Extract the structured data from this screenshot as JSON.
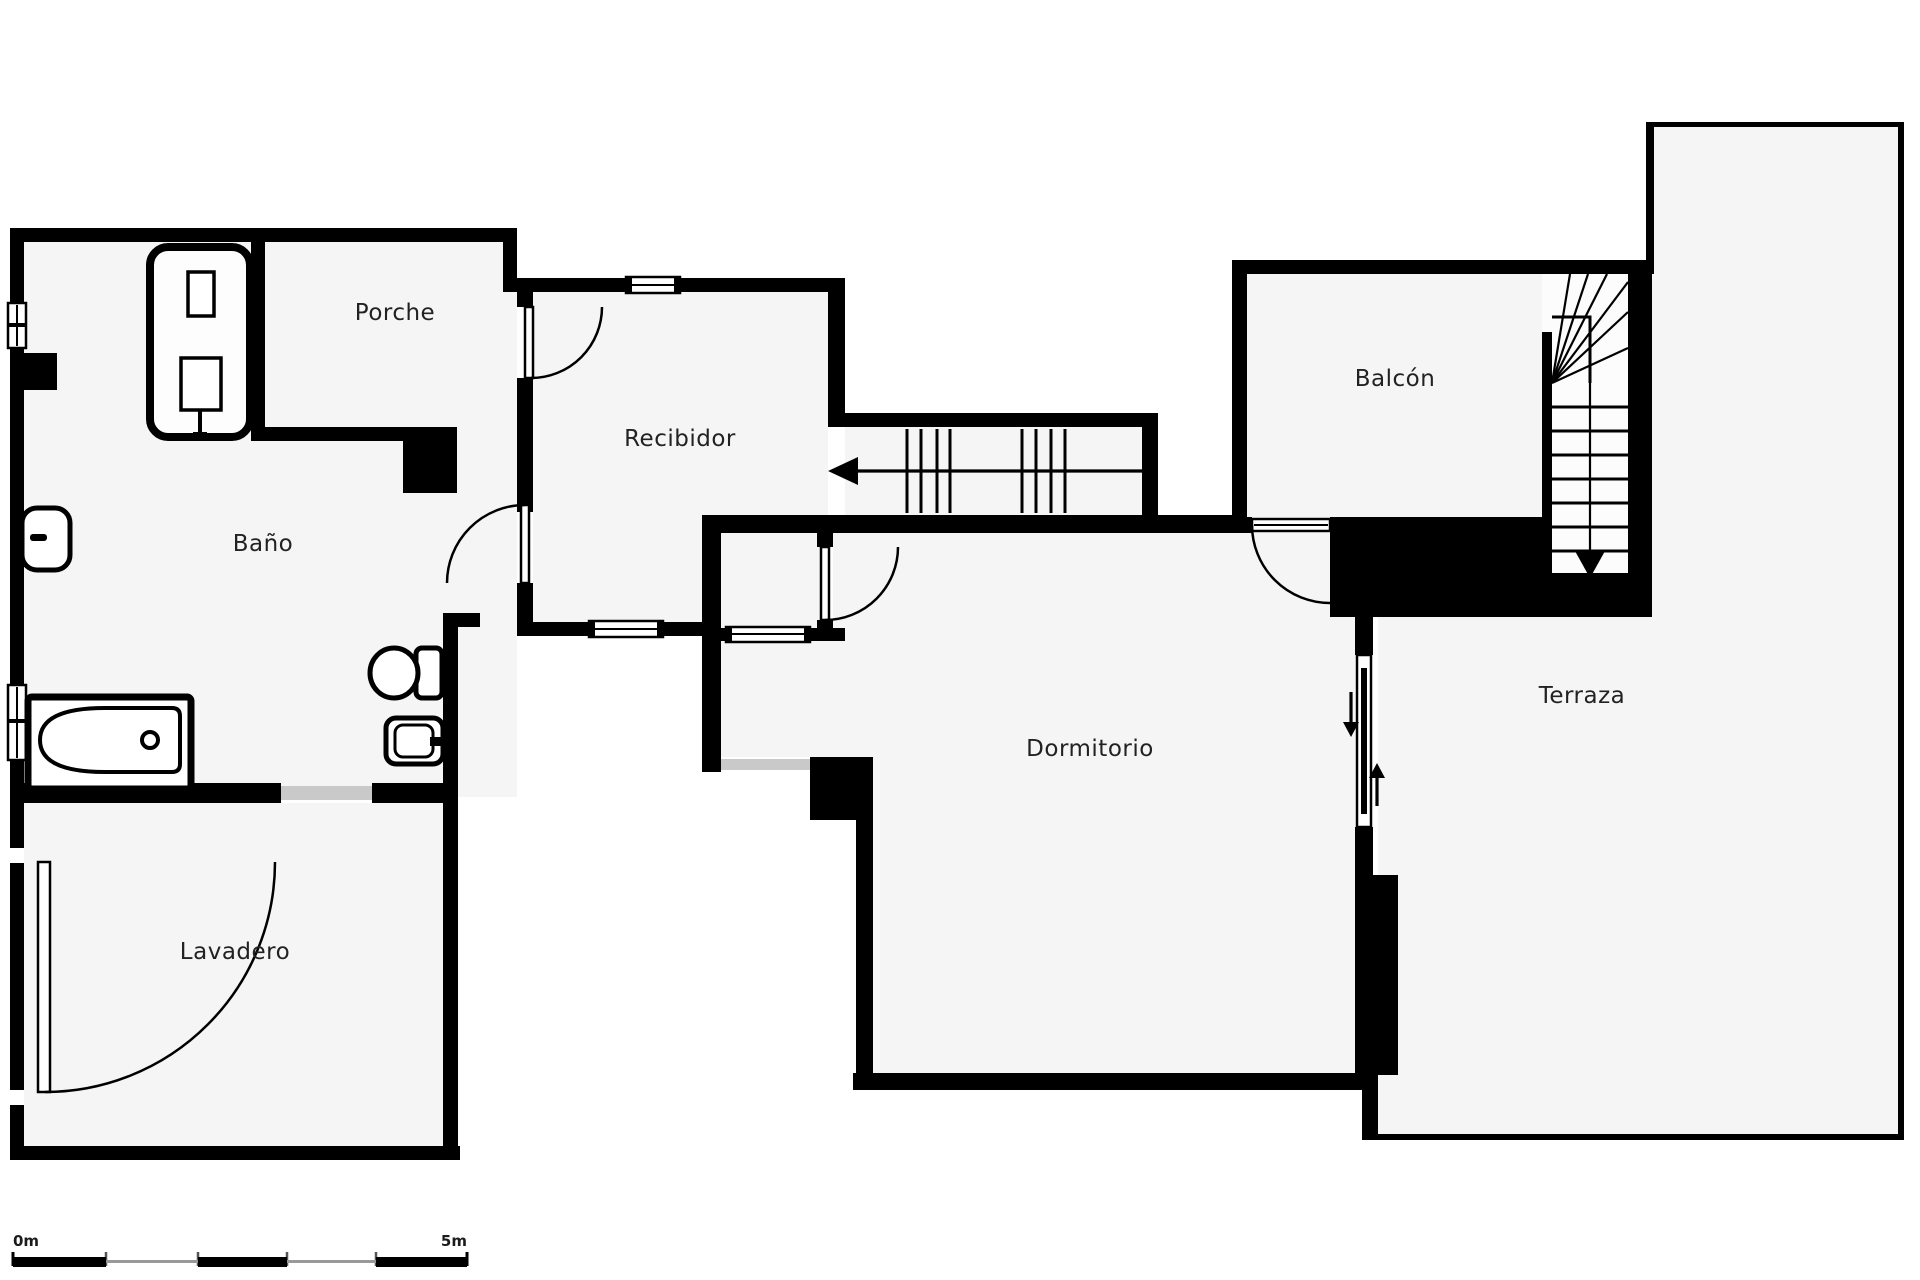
{
  "plan": {
    "type": "floorplan",
    "rooms": [
      {
        "id": "porche",
        "label": "Porche"
      },
      {
        "id": "recibidor",
        "label": "Recibidor"
      },
      {
        "id": "bano",
        "label": "Baño"
      },
      {
        "id": "lavadero",
        "label": "Lavadero"
      },
      {
        "id": "dormitorio",
        "label": "Dormitorio"
      },
      {
        "id": "balcon",
        "label": "Balcón"
      },
      {
        "id": "terraza",
        "label": "Terraza"
      }
    ],
    "stairs": [
      {
        "id": "stairs-corridor",
        "direction": "left-arrow"
      },
      {
        "id": "stairs-main",
        "direction": "down-arrow"
      }
    ],
    "scale_bar": {
      "start_label": "0m",
      "end_label": "5m",
      "segments": 5
    },
    "colors": {
      "wall": "#000000",
      "floor": "#f5f5f5",
      "background": "#ffffff",
      "label_text": "#222222",
      "opening_gray": "#c9c9c9",
      "scale_gray": "#999999"
    }
  }
}
